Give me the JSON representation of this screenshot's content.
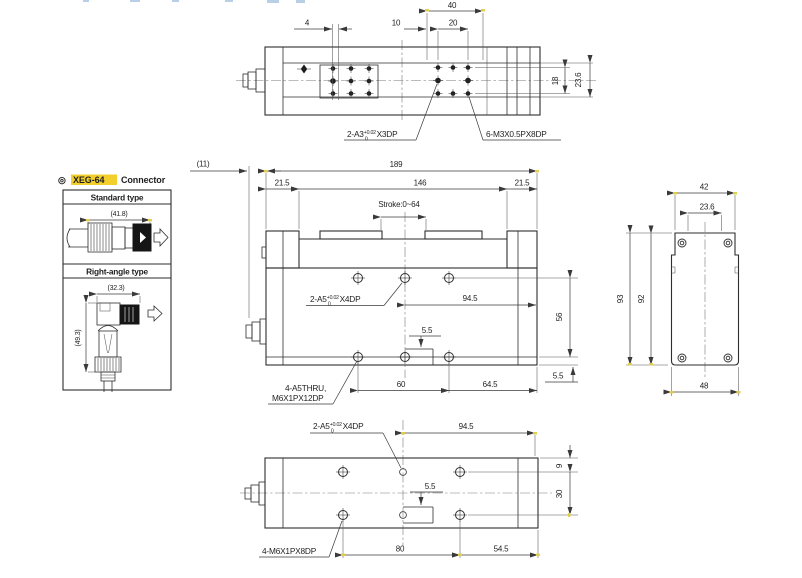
{
  "page": {
    "bg": "#ffffff",
    "line": "#2e2e2e",
    "accent_yellow": "#f2cf2a"
  },
  "connector_panel": {
    "title_symbol": "◎",
    "title_highlight": "XEG-64",
    "title_rest": "Connector",
    "standard_label": "Standard type",
    "standard_dim": "(41.8)",
    "right_angle_label": "Right-angle type",
    "right_angle_width": "(32.3)",
    "right_angle_height": "(49.3)"
  },
  "top_view": {
    "d40": "40",
    "d4": "4",
    "d10": "10",
    "d20": "20",
    "d18": "18",
    "d23_6": "23.6",
    "a3": {
      "prefix": "2-A3",
      "sup": "+0.02",
      "sub": "0",
      "suffix": "X3DP"
    },
    "m3": "6-M3X0.5PX8DP"
  },
  "front_view": {
    "d11": "(11)",
    "d189": "189",
    "d21_5l": "21.5",
    "d146": "146",
    "d21_5r": "21.5",
    "stroke": "Stroke:0~64",
    "a5": {
      "prefix": "2-A5",
      "sup": "+0.02",
      "sub": "0",
      "suffix": "X4DP"
    },
    "d94_5": "94.5",
    "d56": "56",
    "d5_5": "5.5",
    "thru1": "4-A5THRU,",
    "thru2": "M6X1PX12DP",
    "d60": "60",
    "d64_5": "64.5",
    "d5_5b": "5.5"
  },
  "side_view": {
    "d42": "42",
    "d23_6": "23.6",
    "d93": "93",
    "d92": "92",
    "d48": "48"
  },
  "bottom_view": {
    "a5": {
      "prefix": "2-A5",
      "sup": "+0.02",
      "sub": "0",
      "suffix": "X4DP"
    },
    "d94_5": "94.5",
    "d9": "9",
    "d30": "30",
    "d5_5": "5.5",
    "m6": "4-M6X1PX8DP",
    "d80": "80",
    "d54_5": "54.5"
  }
}
